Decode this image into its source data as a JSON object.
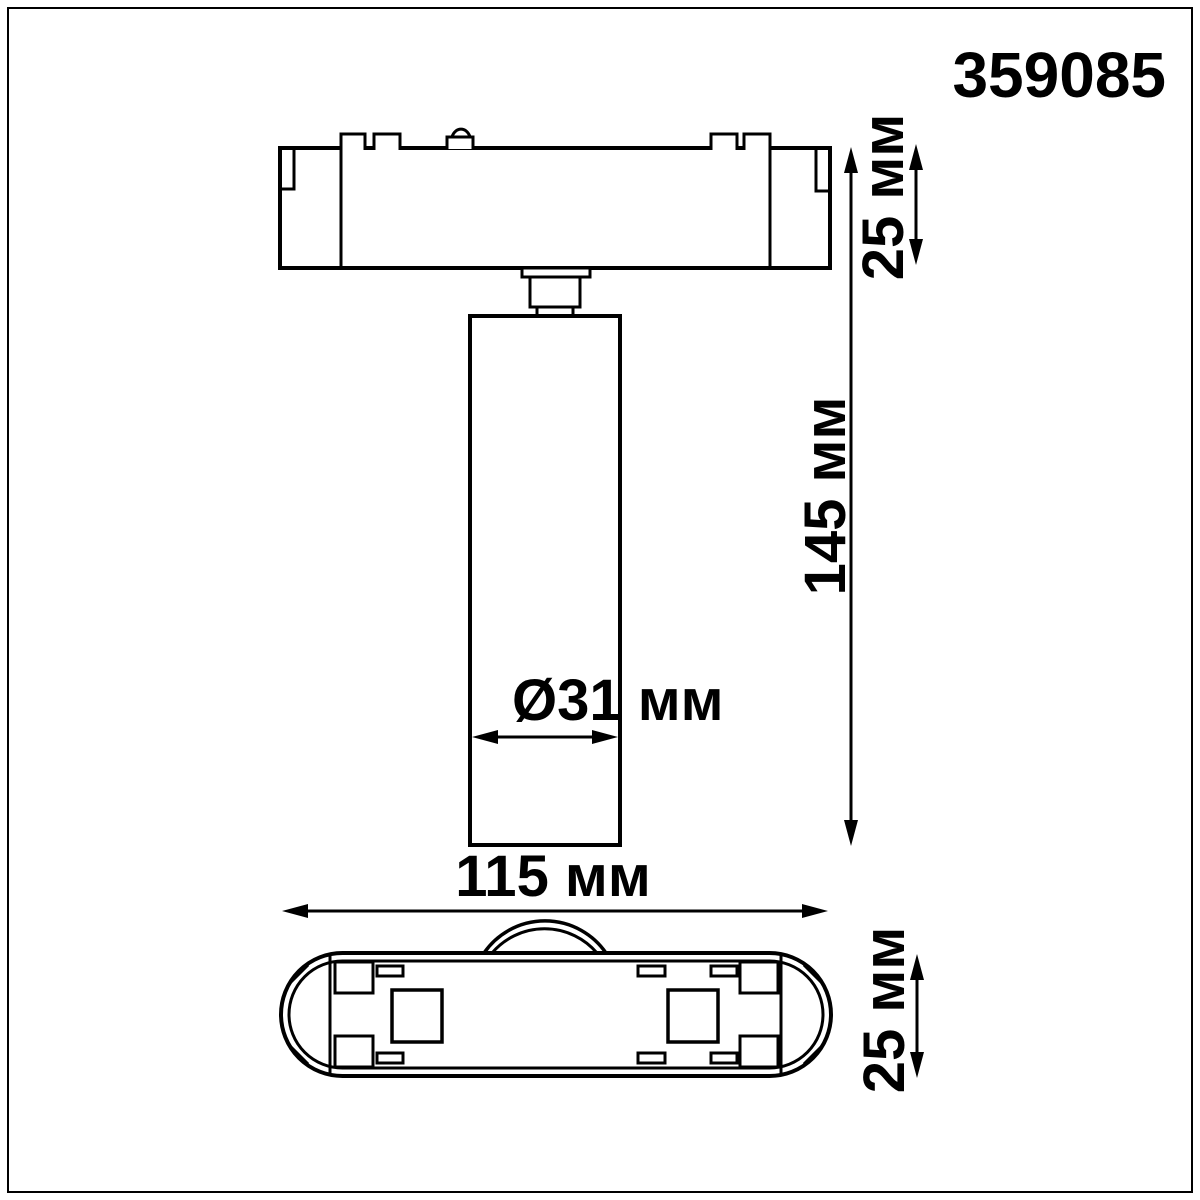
{
  "part_number": "359085",
  "dimensions": {
    "adapter_height": "25 мм",
    "overall_height": "145 мм",
    "spot_diameter": "Ø31 мм",
    "overall_width": "115 мм",
    "base_height": "25 мм"
  },
  "colors": {
    "line": "#000000",
    "background": "#ffffff"
  }
}
